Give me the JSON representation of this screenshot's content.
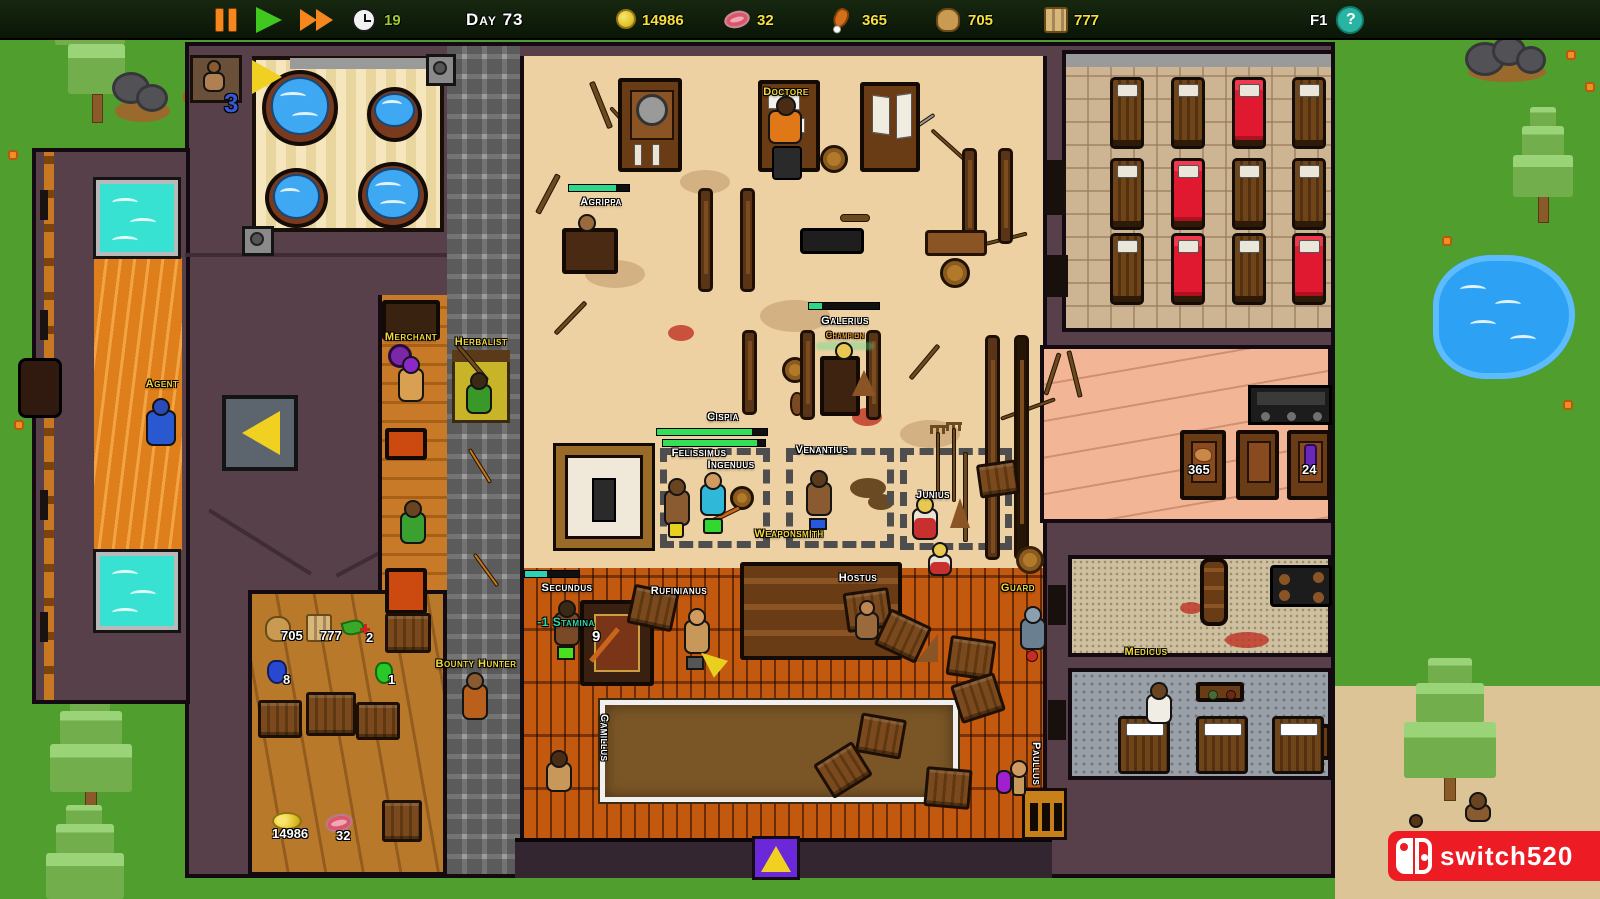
{
  "topbar": {
    "clock_value": "19",
    "day_label": "Day 73",
    "gold": "14986",
    "meat": "32",
    "poultry": "365",
    "grain": "705",
    "wood": "777",
    "help_key": "F1",
    "help_symbol": "?"
  },
  "characters": {
    "doctore": "Doctore",
    "agrippa": "Agrippa",
    "galerius": "Galerius",
    "galerius_title": "Champion",
    "cispia": "Cispia",
    "felissimus": "Felissimus",
    "ingenuus": "Ingenuus",
    "venantius": "Venantius",
    "junius": "Junius",
    "weaponsmith": "Weaponsmith",
    "secundus": "Secundus",
    "rufinianus": "Rufinianus",
    "hostus": "Hostus",
    "guard": "Guard",
    "bounty_hunter": "Bounty Hunter",
    "camillus": "Camillus",
    "paullus": "Paullus",
    "medicus": "Medicus",
    "merchant": "Merchant",
    "herbalist": "Herbalist",
    "agent": "Agent"
  },
  "popups": {
    "stamina_change": "-1 Stamina",
    "stamina_value": "9",
    "bath_queue_count": "3"
  },
  "storage_counts": {
    "grain": "705",
    "wood": "777",
    "herbs": "2",
    "blue_potion": "8",
    "green_potion": "1",
    "gold": "14986",
    "meat": "32"
  },
  "kitchen_counts": {
    "poultry": "365",
    "potion": "24"
  },
  "beds": {
    "colors": [
      "brown",
      "brown",
      "red",
      "brown",
      "brown",
      "red",
      "brown",
      "brown",
      "brown",
      "red",
      "brown",
      "red"
    ]
  },
  "watermark": {
    "text": "switch520"
  },
  "colors": {
    "accent_yellow": "#f2d838",
    "label_white": "#ffffff",
    "champion_orange": "#f0a030",
    "stamina_teal": "#2fd8a8",
    "health_green": "#33e055",
    "watermark_red": "#ed1c24",
    "help_teal": "#29b3a2"
  }
}
